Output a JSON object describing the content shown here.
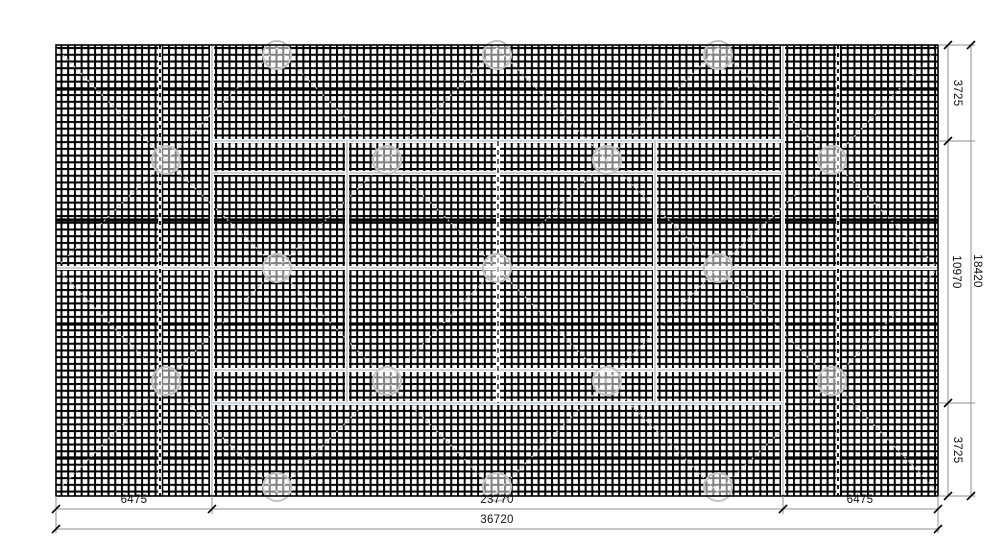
{
  "dimensions": {
    "bottom": {
      "left": "6475",
      "middle": "23770",
      "right": "6475",
      "total": "36720"
    },
    "right": {
      "top": "3725",
      "middle": "10970",
      "bottom": "3725",
      "total": "18420"
    }
  },
  "drawing": {
    "panel": {
      "x": 56,
      "y": 45,
      "w": 882,
      "h": 451
    },
    "grid_cell": 6.72,
    "colors": {
      "grid": "#000000",
      "gray": "#c2c2c2",
      "blue": "#b9c8d8",
      "dark": "#3a3a3a",
      "dim": "#8f8f8f",
      "tick": "#000000"
    },
    "heavy_band_y": [
      89,
      220,
      324,
      458
    ],
    "dashed_vertical_x": [
      160,
      838
    ],
    "overlay_lines": [
      {
        "x1": 212,
        "y1": 45,
        "x2": 212,
        "y2": 496,
        "color": "gray"
      },
      {
        "x1": 783,
        "y1": 45,
        "x2": 783,
        "y2": 496,
        "color": "gray"
      },
      {
        "x1": 212,
        "y1": 141,
        "x2": 783,
        "y2": 141,
        "color": "blue"
      },
      {
        "x1": 212,
        "y1": 403,
        "x2": 783,
        "y2": 403,
        "color": "blue"
      },
      {
        "x1": 56,
        "y1": 268,
        "x2": 938,
        "y2": 268,
        "color": "gray"
      },
      {
        "x1": 212,
        "y1": 173,
        "x2": 783,
        "y2": 173,
        "color": "gray"
      },
      {
        "x1": 212,
        "y1": 370,
        "x2": 783,
        "y2": 370,
        "color": "gray"
      },
      {
        "x1": 347,
        "y1": 141,
        "x2": 347,
        "y2": 403,
        "color": "gray"
      },
      {
        "x1": 655,
        "y1": 141,
        "x2": 655,
        "y2": 403,
        "color": "gray"
      },
      {
        "x1": 498,
        "y1": 141,
        "x2": 498,
        "y2": 403,
        "color": "dark",
        "dash": "5,4"
      }
    ],
    "lattice_rows": [
      {
        "y": 48,
        "x": [
          56,
          277,
          497,
          718,
          938
        ]
      },
      {
        "y": 160,
        "x": [
          166,
          387,
          607,
          832
        ]
      },
      {
        "y": 268,
        "x": [
          56,
          277,
          497,
          718,
          938
        ]
      },
      {
        "y": 381,
        "x": [
          166,
          387,
          607,
          832
        ]
      },
      {
        "y": 492,
        "x": [
          56,
          277,
          497,
          718,
          938
        ]
      }
    ],
    "anchor_radius": 14,
    "anchors": [
      [
        277,
        55
      ],
      [
        497,
        55
      ],
      [
        718,
        55
      ],
      [
        166,
        160
      ],
      [
        387,
        160
      ],
      [
        607,
        160
      ],
      [
        832,
        160
      ],
      [
        277,
        268
      ],
      [
        497,
        268
      ],
      [
        718,
        268
      ],
      [
        166,
        381
      ],
      [
        387,
        381
      ],
      [
        607,
        381
      ],
      [
        832,
        381
      ],
      [
        277,
        487
      ],
      [
        497,
        487
      ],
      [
        718,
        487
      ]
    ],
    "dim": {
      "right": {
        "inner_x": 948,
        "outer_x": 971,
        "ext_y": [
          45,
          141,
          403,
          496
        ]
      },
      "bottom": {
        "inner_y": 509,
        "outer_y": 529,
        "ext_x": [
          56,
          212,
          783,
          938
        ]
      }
    }
  }
}
